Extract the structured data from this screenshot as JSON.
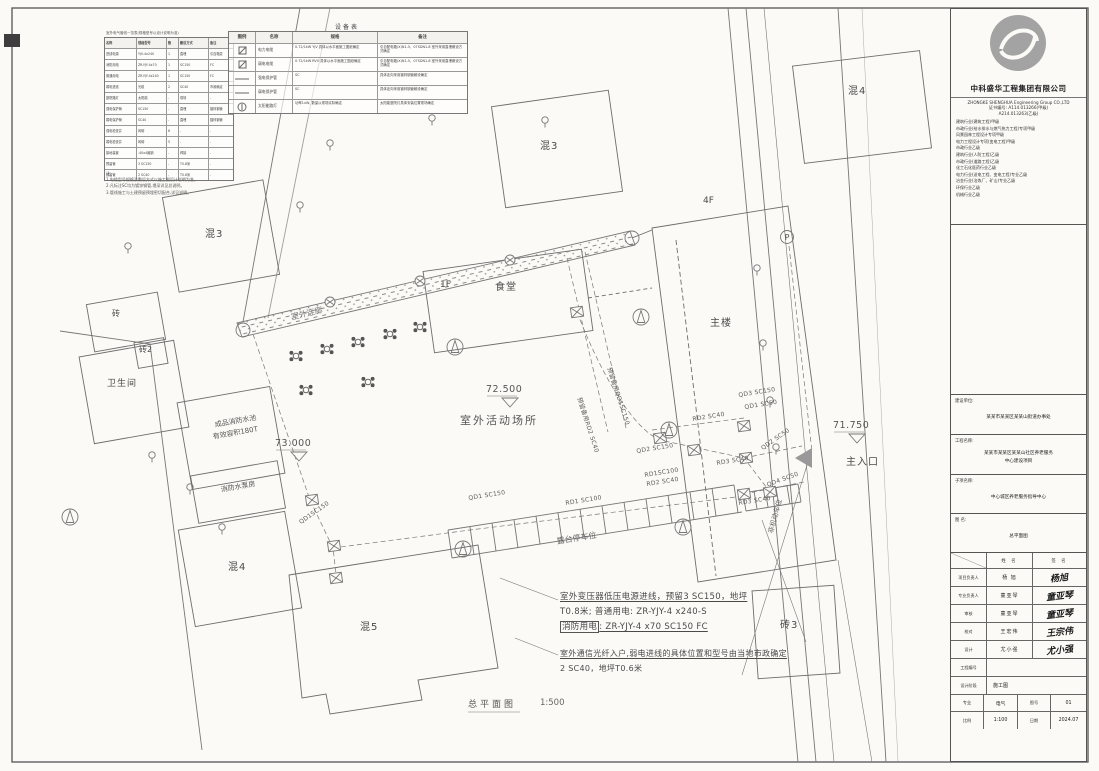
{
  "plan": {
    "buildings": {
      "hun4_top": "混4",
      "hun3_mid": "混3",
      "hun3_left": "混3",
      "zhuan": "砖",
      "zhuan2": "砖2",
      "toilet": "卫生间",
      "tank_l1": "成品消防水池",
      "tank_l2": "有效容积180T",
      "pump": "消防水泵房",
      "hun4_bottom": "混4",
      "hun5": "混5",
      "zhuan3": "砖3",
      "canteen": "食堂",
      "canteen_floor": "1F",
      "main": "主楼",
      "main_floor": "4F"
    },
    "areas": {
      "corridor": "室外连廊",
      "activity": "室外活动场所",
      "parking": "露台停车位",
      "bike": "非机动车位",
      "entrance": "主入口",
      "p": "P"
    },
    "elevations": {
      "e73": "73.000",
      "e72": "72.500",
      "e71": "71.750"
    },
    "cables": {
      "qd1a": "QD1SC150",
      "qd1b": "QD1 SC150",
      "rd1a": "RD1 SC100",
      "qd2a": "QD2 SC150",
      "rd1b": "RD1SC100",
      "rd2a": "RD2 SC40",
      "rd2b": "RD2 SC40",
      "rd3a": "RD3 SC40",
      "rd3b": "RD3 SC40",
      "qd2b": "QD2 SC50",
      "qd3a": "QD3 SC150",
      "qd1c": "QD1 SC50",
      "qd4": "QD4 SC50",
      "reserve1": "预留备用QD1SC150",
      "reserve2": "预留备用RD2 SC40"
    }
  },
  "notes": {
    "b1l1": "室外变压器低压电源进线，预留3 SC150，地坪",
    "b1l2": "T0.8米; 普通用电: ZR-YJY-4 x240-S",
    "b1l3a": "消防用电",
    "b1l3b": ": ZR-YJY-4 x70  SC150  FC",
    "b2l1": "室外通信光纤入户,弱电进线的具体位置和型号由当地市政确定",
    "b2l2": "2 SC40，地坪T0.6米"
  },
  "footer": {
    "title": "总平面图",
    "scale": "1:500"
  },
  "equipment_table": {
    "caption": "设备表",
    "headers": [
      "图例",
      "名称",
      "规格",
      "备注"
    ],
    "rows": [
      {
        "icon": "cable-tray-icon",
        "name": "电力电缆",
        "spec": "0.72/1kW YJV 具体以水平面施工图纸确定",
        "note": "引自配电箱(X)N1-5、07SDN1-8 室外采用直埋敷设方式确定"
      },
      {
        "icon": "cable-tray-icon",
        "name": "弱电电缆",
        "spec": "0.72/1kW RVV 具体以水平面施工图纸确定",
        "note": "引自配电箱(X)N1-5、07SDN1-8 室外采用直埋敷设方式确定"
      },
      {
        "icon": "conduit-line-icon",
        "name": "强电保护管",
        "spec": "SC",
        "note": "具体走向采用镀锌钢管敷设确定"
      },
      {
        "icon": "conduit-line-icon",
        "name": "弱电保护管",
        "spec": "SC",
        "note": "具体走向采用镀锌钢管敷设确定"
      },
      {
        "icon": "lamp-icon",
        "name": "太阳能路灯",
        "spec": "功率1xW, 数量以现场实际确定",
        "note": "太阳能庭院灯具体安装位置现场确定"
      }
    ]
  },
  "spec_table": {
    "caption": "室外电气管线一览表(规格型号以设计说明为准)",
    "headers": [
      "名称",
      "规格型号",
      "数",
      "敷设方式",
      "备注"
    ],
    "rows": [
      [
        "进线电源",
        "YJV-4x240",
        "1",
        "直埋",
        "引自箱变"
      ],
      [
        "消防用电",
        "ZR-YJY-4x70",
        "1",
        "SC150",
        "FC"
      ],
      [
        "普通用电",
        "ZR-YJY-4x240",
        "1",
        "SC150",
        "FC"
      ],
      [
        "弱电进线",
        "光缆",
        "2",
        "SC40",
        "市政确定"
      ],
      [
        "庭院路灯",
        "太阳能",
        "-",
        "现场",
        "-"
      ],
      [
        "强电保护管",
        "SC150",
        "-",
        "直埋",
        "镀锌钢管"
      ],
      [
        "弱电保护管",
        "SC40",
        "-",
        "直埋",
        "镀锌钢管"
      ],
      [
        "强电检查井",
        "砖砌",
        "6",
        "-",
        "-"
      ],
      [
        "弱电检查井",
        "砖砌",
        "5",
        "-",
        "-"
      ],
      [
        "接地装置",
        "-40x4扁钢",
        "-",
        "焊接",
        "-"
      ],
      [
        "预留管",
        "3 SC150",
        "-",
        "T0.8米",
        "-"
      ],
      [
        "预留管",
        "2 SC40",
        "-",
        "T0.6米",
        "-"
      ]
    ],
    "notes": [
      "注:",
      "1.电缆型号规格及敷设方式以施工图设计说明为准。",
      "2.凡标注SC均为镀锌钢管,埋深详见总说明。",
      "3.管线施工与土建预留预埋密切配合,详见说明。"
    ]
  },
  "titleblock": {
    "company_cn": "中科盛华工程集团有限公司",
    "company_en": "ZHONGKE SHENGHUA Engineering Group CO.,LTD",
    "cert1": "证书编号: A114.013266(甲级)",
    "cert2": "A214.013263(乙级)",
    "quals": [
      "建筑行业(建筑工程)甲级",
      "市政行业(给水排水与燃气热力工程)专项甲级",
      "风景园林工程设计专项甲级",
      "电力工程设计专项(变电工程)甲级",
      "市政行业乙级",
      "建筑行业(人防工程)乙级",
      "市政行业(道路工程)乙级",
      "化工石化医药行业乙级",
      "电力行业(送电工程、变电工程)专业乙级",
      "冶金行业(冶炼厂、矿山)专业乙级",
      "环保行业乙级",
      "机械行业乙级"
    ],
    "client_label": "建设单位:",
    "client": "某某市某某区某某山街道办事处",
    "project_label": "工程名称:",
    "project_l1": "某某市某某区某某山社区养老服务",
    "project_l2": "中心建设项目",
    "sub_label": "子项名称:",
    "sub": "中心城区养老服务指导中心",
    "drawing_label": "图    名:",
    "drawing": "总平面图",
    "sig": {
      "header_name": "姓 名",
      "header_sign": "签 名",
      "rows": [
        {
          "role": "项目负责人",
          "name": "杨 旭",
          "sign": "杨旭"
        },
        {
          "role": "专业负责人",
          "name": "童亚琴",
          "sign": "童亚琴"
        },
        {
          "role": "审核",
          "name": "童亚琴",
          "sign": "童亚琴"
        },
        {
          "role": "校对",
          "name": "王宏伟",
          "sign": "王宗伟"
        },
        {
          "role": "设计",
          "name": "尤小强",
          "sign": "尤小强"
        }
      ]
    },
    "info": {
      "eng_no_label": "工程编号",
      "stage_label": "设计阶段",
      "stage": "施工图",
      "major_label": "专业",
      "major": "电气",
      "fig_label": "图号",
      "fig": "01",
      "scale_label": "比例",
      "scale": "1:100",
      "date_label": "日期",
      "date": "2024.07"
    }
  }
}
